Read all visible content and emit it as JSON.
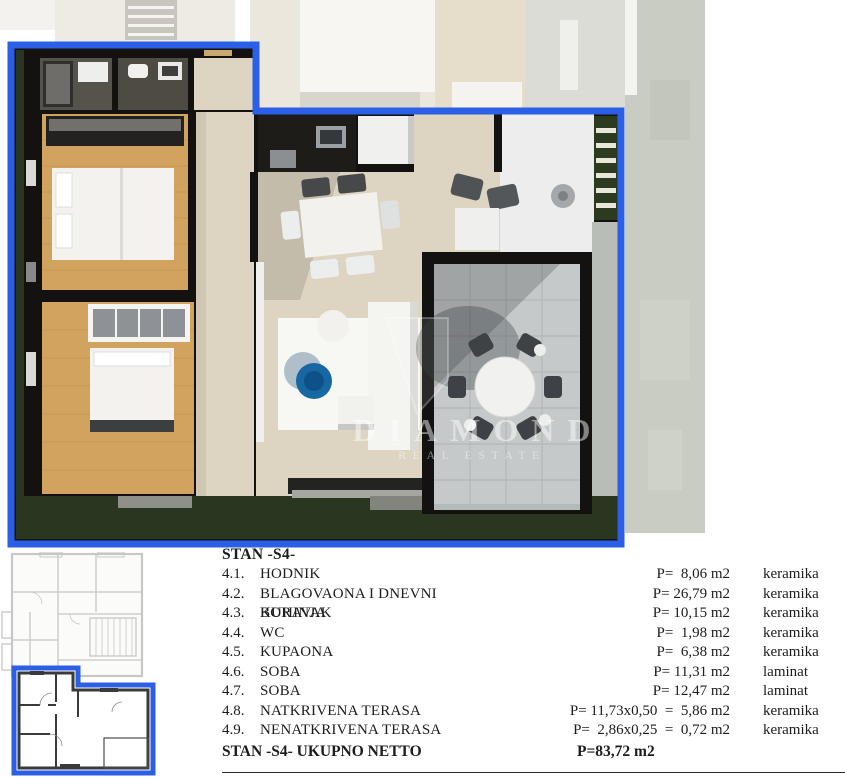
{
  "floor_plan_3d": {
    "description": "3d-rendered-apartment-floor-plan-unit-s4",
    "watermark": {
      "logo": "diamond-shield-logo",
      "line1": "DIAMOND",
      "line2": "REAL ESTATE"
    },
    "colors": {
      "highlight_blue": "#2b5fe6",
      "wall_dark": "#131210",
      "tile_beige": "#ddd5c2",
      "wood_floor": "#d2a25f",
      "terrace_stone": "#c5c9c9",
      "grass_green": "#2a3620",
      "coffee_table_blue": "#1767a3",
      "backdrop_faded": "#ebe7dc",
      "gravel_gray": "#c9ccc2"
    }
  },
  "mini_plan": {
    "description": "building-level-location-plan-with-unit-highlighted",
    "colors": {
      "faded_line": "#c7c7c5",
      "unit_wall": "#3a3a38",
      "highlight_blue": "#2b5fe6"
    }
  },
  "table": {
    "title": "STAN -S4-",
    "rows": [
      {
        "num": "4.1.",
        "name": "HODNIK",
        "area": "P=  8,06 m2",
        "material": "keramika"
      },
      {
        "num": "4.2.",
        "name": "BLAGOVAONA I DNEVNI BORAVAK",
        "area": "P= 26,79 m2",
        "material": "keramika"
      },
      {
        "num": "4.3.",
        "name": "KUHINJA",
        "area": "P= 10,15 m2",
        "material": "keramika"
      },
      {
        "num": "4.4.",
        "name": "WC",
        "area": "P=  1,98 m2",
        "material": "keramika"
      },
      {
        "num": "4.5.",
        "name": "KUPAONA",
        "area": "P=  6,38 m2",
        "material": "keramika"
      },
      {
        "num": "4.6.",
        "name": "SOBA",
        "area": "P= 11,31 m2",
        "material": "laminat"
      },
      {
        "num": "4.7.",
        "name": "SOBA",
        "area": "P= 12,47 m2",
        "material": "laminat"
      },
      {
        "num": "4.8.",
        "name": "NATKRIVENA TERASA",
        "area": "P= 11,73x0,50  =  5,86 m2",
        "material": "keramika"
      },
      {
        "num": "4.9.",
        "name": "NENATKRIVENA TERASA",
        "area": "P=  2,86x0,25  =  0,72 m2",
        "material": "keramika"
      }
    ],
    "total": {
      "label": "STAN -S4- UKUPNO NETTO",
      "area": "P=83,72 m2"
    }
  }
}
